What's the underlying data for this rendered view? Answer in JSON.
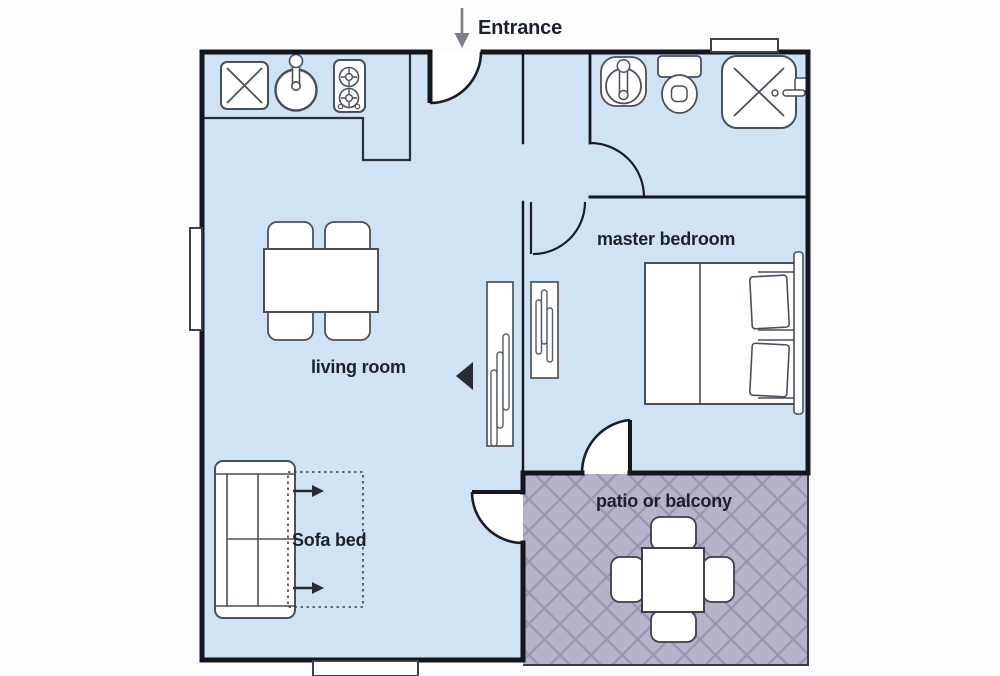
{
  "title": "apartment floor plan",
  "labels": {
    "entrance": "Entrance",
    "living_room": "living room",
    "master_bedroom": "master bedroom",
    "sofa_bed": "Sofa bed",
    "patio": "patio or balcony"
  },
  "rooms": [
    {
      "name": "kitchen-area"
    },
    {
      "name": "living room"
    },
    {
      "name": "master bedroom"
    },
    {
      "name": "bathroom"
    },
    {
      "name": "patio or balcony"
    },
    {
      "name": "entrance-hall"
    }
  ],
  "furniture": [
    "kitchen-counter",
    "kitchen-cabinet",
    "kitchen-sink",
    "stove-two-burners",
    "dining-table",
    "dining-chairs-x4",
    "sofa-bed",
    "sofa-bed-fold-out-outline",
    "wardrobe-living-side",
    "wardrobe-bedroom-side",
    "double-bed",
    "pillows-x2",
    "headboard",
    "bathroom-sink",
    "toilet",
    "shower",
    "patio-table",
    "patio-chairs-x4"
  ],
  "icons": {
    "entrance_arrow": "down-arrow",
    "sofa_fold_arrows": "right-arrow"
  },
  "colors": {
    "floor": "#cfe3f4",
    "patio_base": "#b7b2c9",
    "patio_hatch": "#9a94b1",
    "wall": "#14161f",
    "fixture_outline": "#4a4f5c",
    "label_text": "#1c222c",
    "arrow_gray": "#7d7d89",
    "background": "#ffffff"
  }
}
